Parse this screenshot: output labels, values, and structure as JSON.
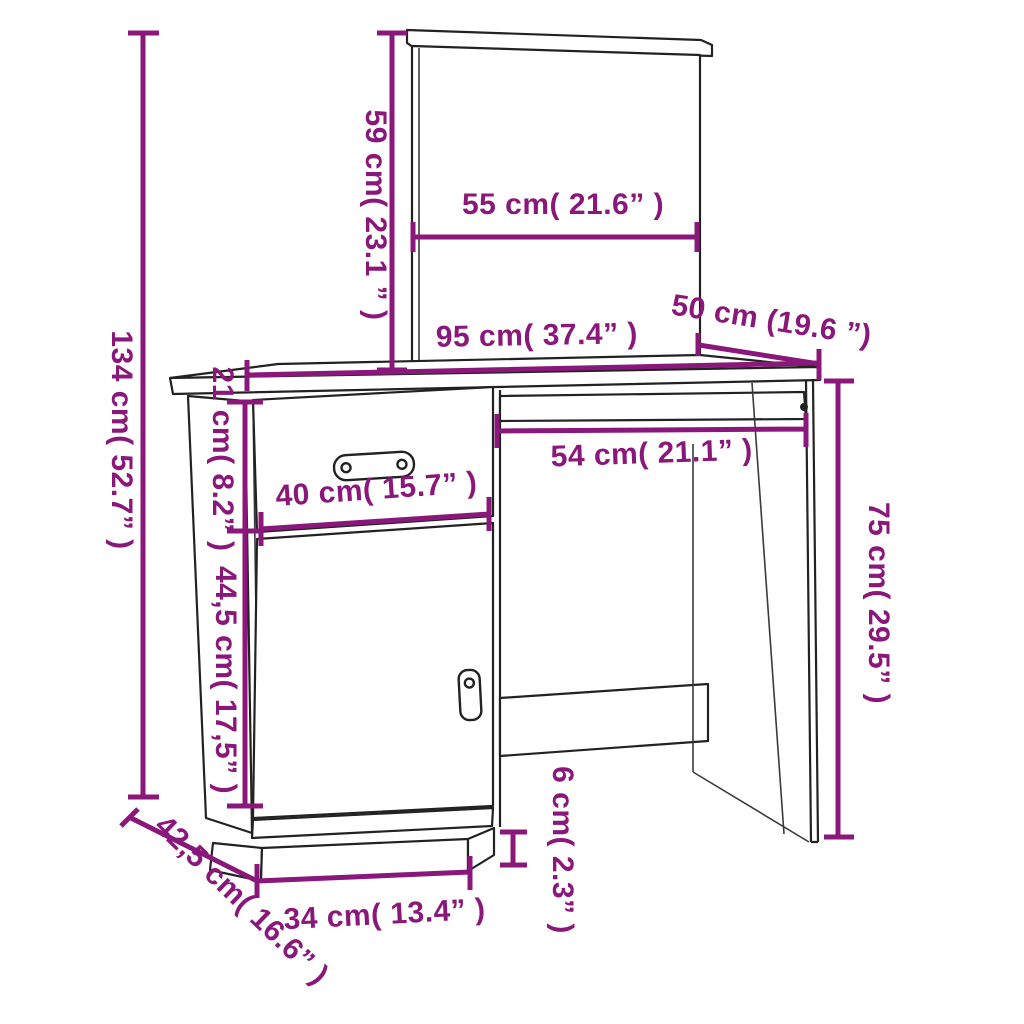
{
  "diagram": {
    "subject": "dressing table with mirror - dimension drawing",
    "accent_color": "#8A177A",
    "line_color": "#222222",
    "background_color": "#FFFFFF",
    "unit_primary": "cm",
    "unit_secondary": "inch"
  },
  "dimensions": {
    "total_height": {
      "label": "134 cm( 52.7” )",
      "cm": "134",
      "inches": "52.7"
    },
    "mirror_height": {
      "label": "59 cm( 23.1 ” )",
      "cm": "59",
      "inches": "23.1"
    },
    "mirror_width": {
      "label": "55 cm( 21.6” )",
      "cm": "55",
      "inches": "21.6"
    },
    "desk_width": {
      "label": "95 cm( 37.4” )",
      "cm": "95",
      "inches": "37.4"
    },
    "desk_depth": {
      "label": "50 cm (19.6 ”)",
      "cm": "50",
      "inches": "19.6"
    },
    "apron_height": {
      "label": "21 cm( 8.2” )",
      "cm": "21",
      "inches": "8.2"
    },
    "drawer_width": {
      "label": "40 cm( 15.7” )",
      "cm": "40",
      "inches": "15.7"
    },
    "tray_width": {
      "label": "54 cm( 21.1” )",
      "cm": "54",
      "inches": "21.1"
    },
    "door_height": {
      "label": "44,5 cm( 17,5” )",
      "cm": "44,5",
      "inches": "17,5"
    },
    "clearance_height": {
      "label": "75 cm( 29.5” )",
      "cm": "75",
      "inches": "29.5"
    },
    "plinth_height": {
      "label": "6 cm( 2.3” )",
      "cm": "6",
      "inches": "2.3"
    },
    "base_depth": {
      "label": "42,5 cm( 16.6” )",
      "cm": "42,5",
      "inches": "16.6"
    },
    "base_width": {
      "label": "34 cm( 13.4” )",
      "cm": "34",
      "inches": "13.4"
    }
  }
}
